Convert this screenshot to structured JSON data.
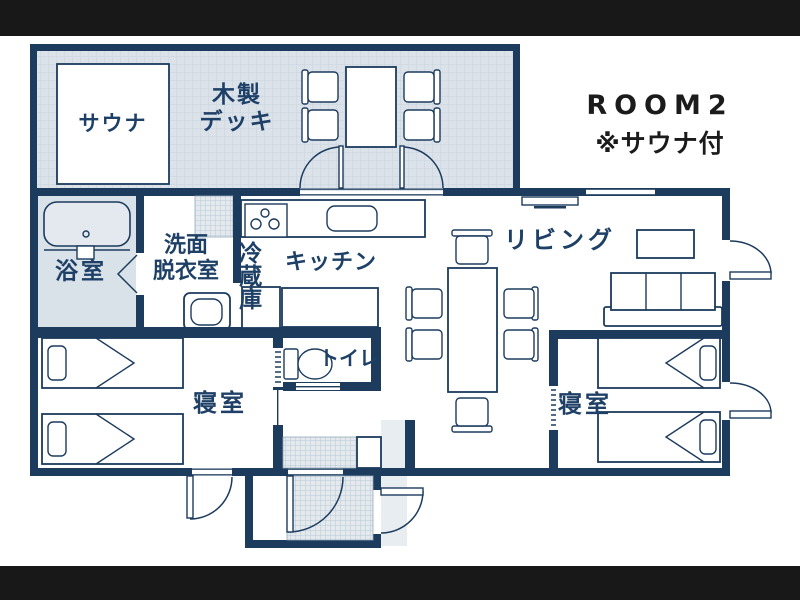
{
  "header": {
    "room_title": "ROOM2",
    "room_subtitle": "※サウナ付"
  },
  "labels": {
    "sauna": "サウナ",
    "deck": [
      "木製",
      "デッキ"
    ],
    "bath": "浴室",
    "washroom": [
      "洗面",
      "脱衣室"
    ],
    "fridge": "冷蔵庫",
    "kitchen": "キッチン",
    "living": "リビング",
    "toilet": "トイレ",
    "bedroom_left": "寝室",
    "bedroom_right": "寝室"
  },
  "colors": {
    "wall": "#1c3b5d",
    "text_navy": "#1e4066",
    "title_color": "#1b1b1b",
    "deck_fill": "#dbe2e9",
    "deck_line": "#c9d4dd",
    "hatch_fill": "#e4e9ee",
    "hatch_line": "#bac9d6",
    "bath_fill": "#d9e1e9",
    "tub_fill": "#e3e9ef",
    "porch_fill": "#dde4ea",
    "letterbox": "#181818",
    "bg": "#ffffff"
  }
}
